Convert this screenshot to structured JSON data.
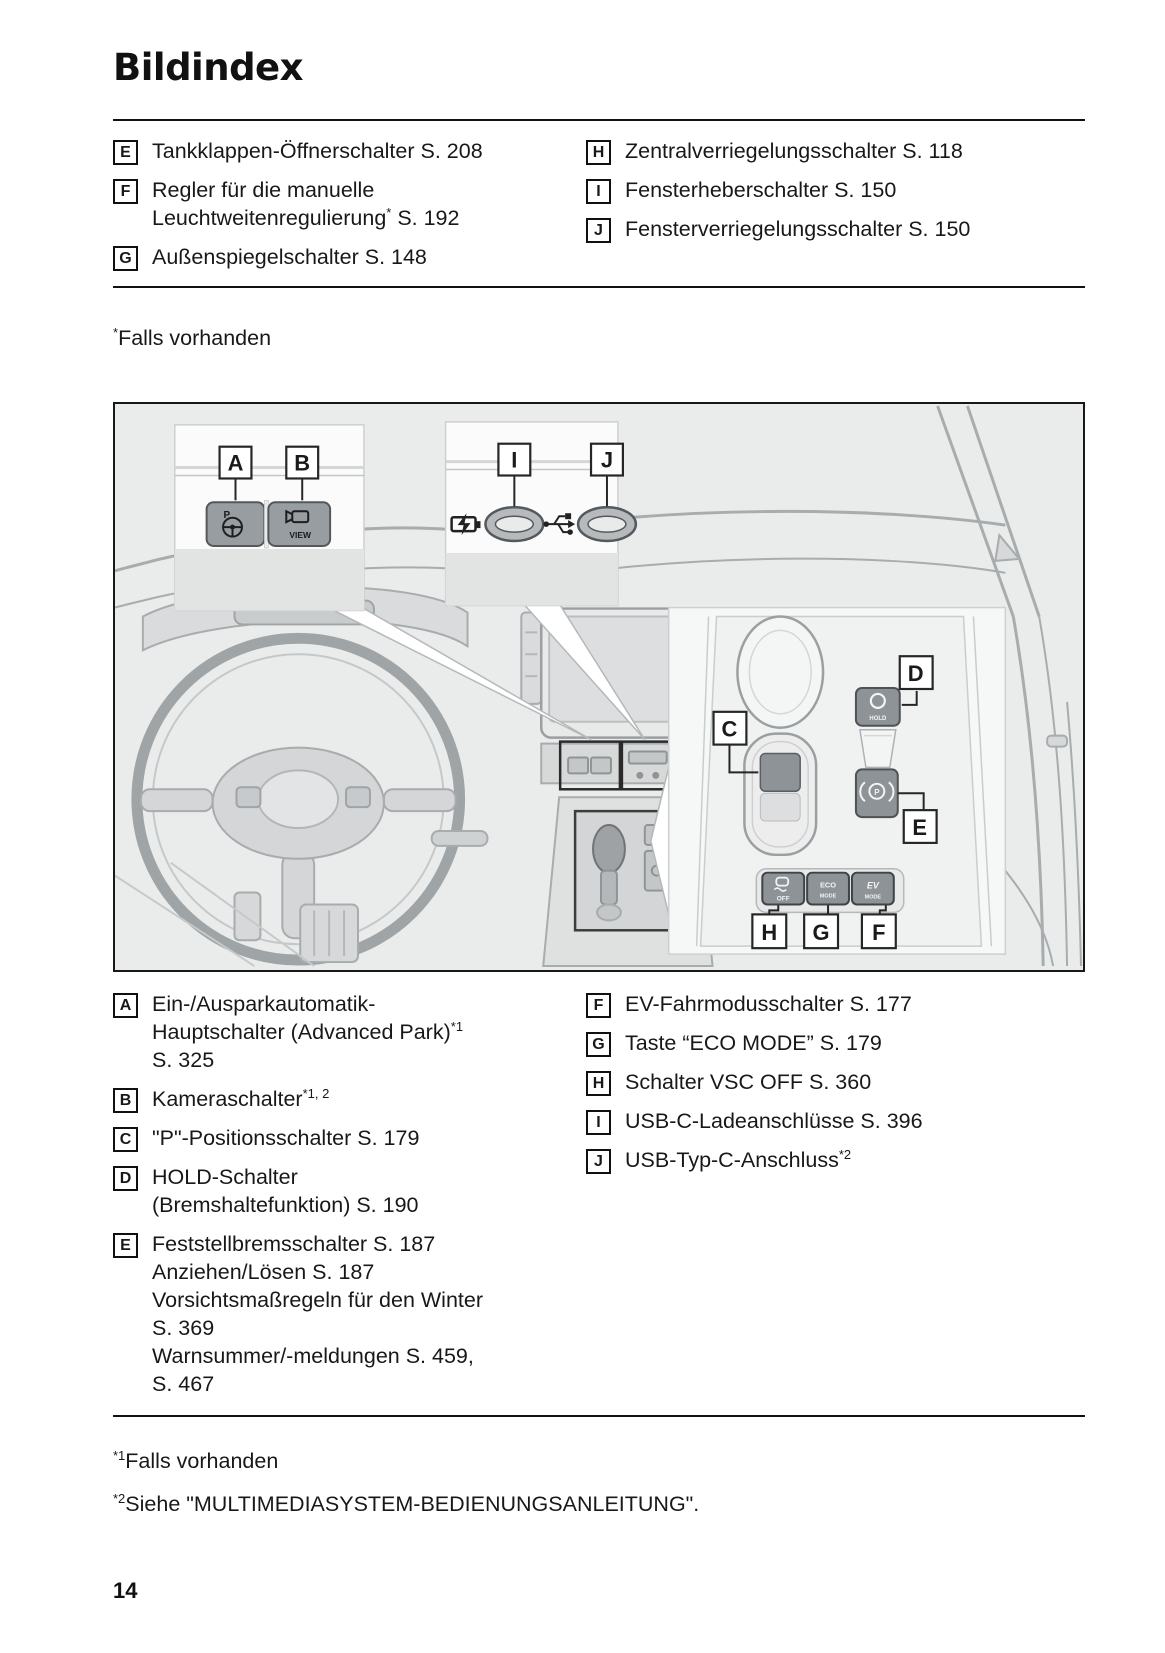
{
  "page": {
    "title": "Bildindex",
    "number": "14"
  },
  "notes": {
    "top": {
      "sup": "*",
      "text": "Falls vorhanden"
    },
    "bottom": [
      {
        "sup": "*1",
        "text": "Falls vorhanden"
      },
      {
        "sup": "*2",
        "text": "Siehe \"MULTIMEDIASYSTEM-BEDIENUNGSANLEITUNG\"."
      }
    ]
  },
  "index_top": {
    "left": [
      {
        "letter": "E",
        "lines": [
          [
            {
              "text": "Tankklappen-Öffnerschalter S. 208"
            }
          ]
        ]
      },
      {
        "letter": "F",
        "lines": [
          [
            {
              "text": "Regler für die manuelle"
            }
          ],
          [
            {
              "text": "Leuchtweitenregulierung"
            },
            {
              "text": "*",
              "sup": true
            },
            {
              "text": " S. 192"
            }
          ]
        ]
      },
      {
        "letter": "G",
        "lines": [
          [
            {
              "text": "Außenspiegelschalter S. 148"
            }
          ]
        ]
      }
    ],
    "right": [
      {
        "letter": "H",
        "lines": [
          [
            {
              "text": "Zentralverriegelungsschalter S. 118"
            }
          ]
        ]
      },
      {
        "letter": "I",
        "lines": [
          [
            {
              "text": "Fensterheberschalter S. 150"
            }
          ]
        ]
      },
      {
        "letter": "J",
        "lines": [
          [
            {
              "text": "Fensterverriegelungsschalter S. 150"
            }
          ]
        ]
      }
    ]
  },
  "index_bottom": {
    "left": [
      {
        "letter": "A",
        "lines": [
          [
            {
              "text": "Ein-/Ausparkautomatik-"
            }
          ],
          [
            {
              "text": "Hauptschalter (Advanced Park)"
            },
            {
              "text": "*1",
              "sup": true
            }
          ],
          [
            {
              "text": "S. 325"
            }
          ]
        ]
      },
      {
        "letter": "B",
        "lines": [
          [
            {
              "text": "Kameraschalter"
            },
            {
              "text": "*1, 2",
              "sup": true
            }
          ]
        ]
      },
      {
        "letter": "C",
        "lines": [
          [
            {
              "text": "\"P\"-Positionsschalter S. 179"
            }
          ]
        ]
      },
      {
        "letter": "D",
        "lines": [
          [
            {
              "text": "HOLD-Schalter"
            }
          ],
          [
            {
              "text": "(Bremshaltefunktion) S. 190"
            }
          ]
        ]
      },
      {
        "letter": "E",
        "lines": [
          [
            {
              "text": "Feststellbremsschalter S. 187"
            }
          ],
          [
            {
              "text": "Anziehen/Lösen S. 187"
            }
          ],
          [
            {
              "text": "Vorsichtsmaßregeln für den Winter"
            }
          ],
          [
            {
              "text": "S. 369"
            }
          ],
          [
            {
              "text": "Warnsummer/-meldungen S. 459,"
            }
          ],
          [
            {
              "text": "S. 467"
            }
          ]
        ]
      }
    ],
    "right": [
      {
        "letter": "F",
        "lines": [
          [
            {
              "text": "EV-Fahrmodusschalter S. 177"
            }
          ]
        ]
      },
      {
        "letter": "G",
        "lines": [
          [
            {
              "text": "Taste “ECO MODE” S. 179"
            }
          ]
        ]
      },
      {
        "letter": "H",
        "lines": [
          [
            {
              "text": "Schalter VSC OFF S. 360"
            }
          ]
        ]
      },
      {
        "letter": "I",
        "lines": [
          [
            {
              "text": "USB-C-Ladeanschlüsse S. 396"
            }
          ]
        ]
      },
      {
        "letter": "J",
        "lines": [
          [
            {
              "text": "USB-Typ-C-Anschluss"
            },
            {
              "text": "*2",
              "sup": true
            }
          ]
        ]
      }
    ]
  },
  "figure": {
    "callouts": {
      "a": "A",
      "b": "B",
      "c": "C",
      "d": "D",
      "e": "E",
      "f": "F",
      "g": "G",
      "h": "H",
      "i": "I",
      "j": "J"
    },
    "buttons": {
      "advanced_park_p": "P",
      "camera_view": "VIEW",
      "hold": "HOLD",
      "brake_p": "P",
      "vsc_off": "OFF",
      "eco_line1": "ECO",
      "eco_line2": "MODE",
      "ev_line1": "EV",
      "ev_line2": "MODE"
    }
  }
}
